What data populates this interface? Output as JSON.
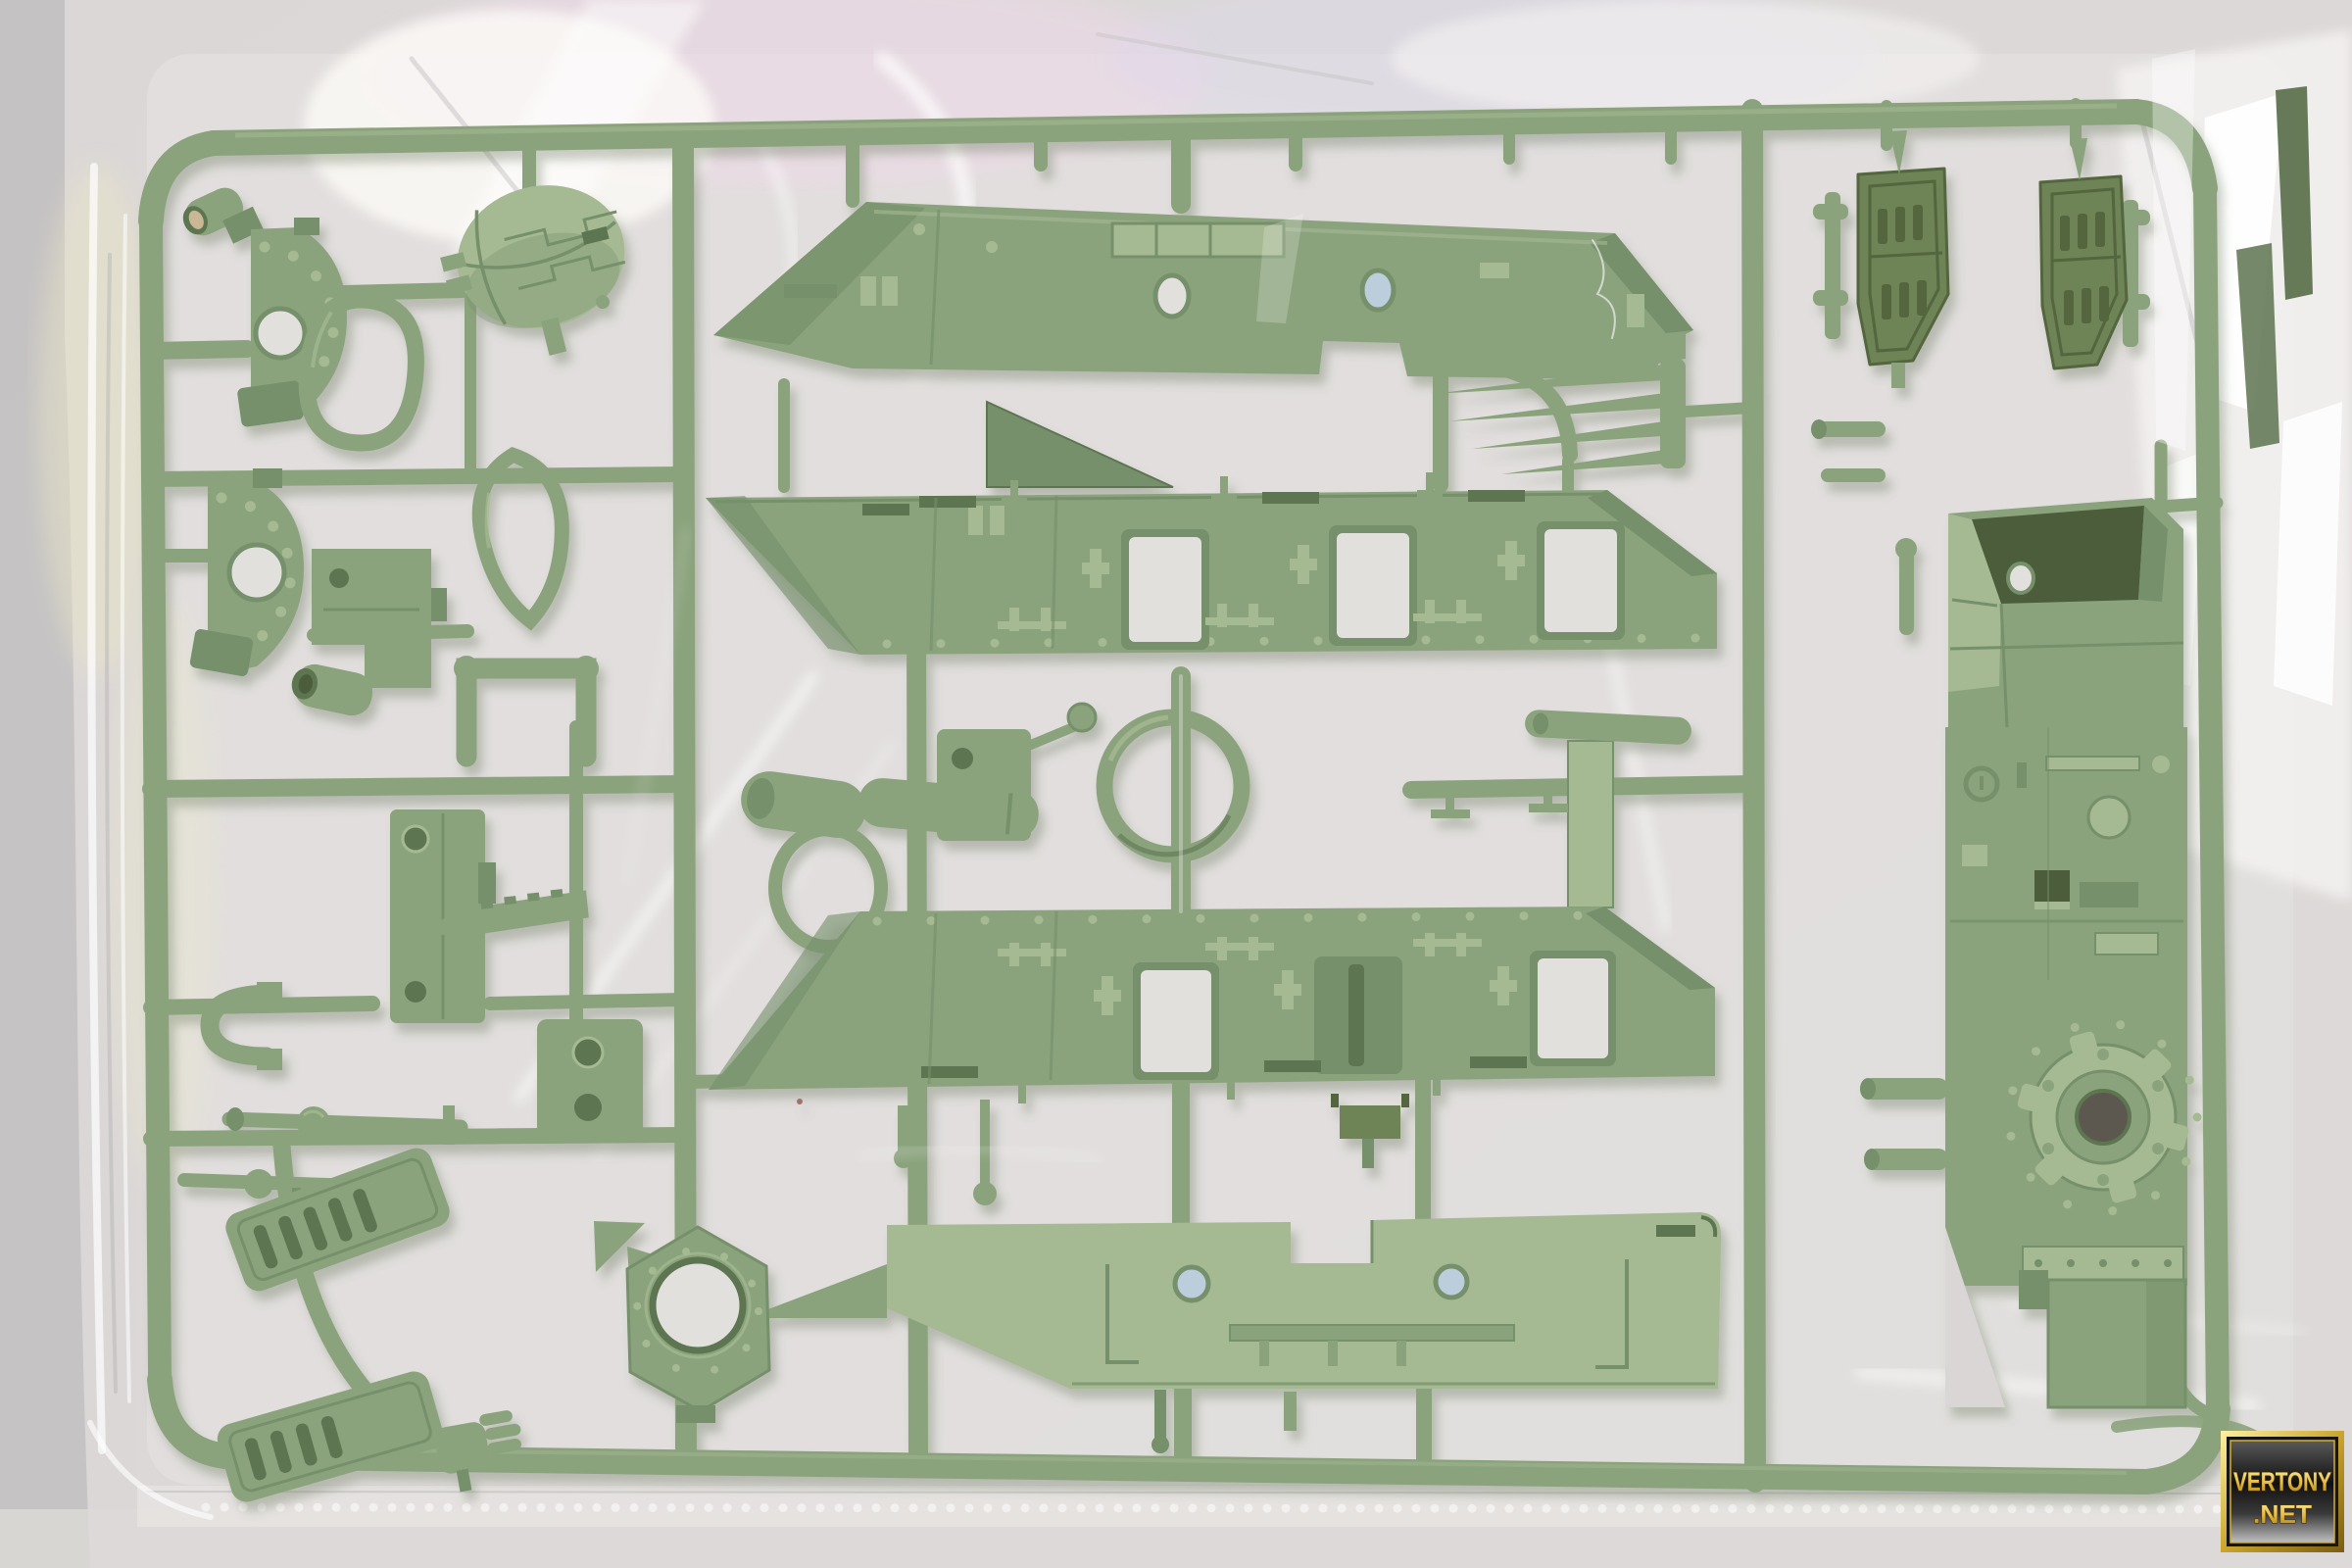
{
  "scene": {
    "description": "Photograph of an olive-green injection-molded model kit sprue (parts runner) sealed inside a clear glossy plastic bag, lying on a light gray surface",
    "contents": "tank/mecha hull panels, side skirts with slots, riveted dome mantlets, ball dome, vented hatches, gear hub hull side, rings, pedals and small fittings"
  },
  "watermark": {
    "line1": "VERTONY",
    "line2": ".NET"
  },
  "colors": {
    "bg1": "#c4c2c3",
    "bg2": "#d8d6d3",
    "bag": "#dcd9d8",
    "bag-lt": "#e6e3e2",
    "seam-dot": "#f4f2f0",
    "g1": "#a5b992",
    "g2": "#8ba37d",
    "g3": "#75906a",
    "g4": "#5d7551",
    "g5": "#4b5d3b",
    "olive": "#6e8356",
    "olive-dk": "#53663e",
    "hole": "#e2e0dd",
    "hole-blue": "#bccddb",
    "bore": "#c9b795",
    "dark-part": "#5e7350",
    "wm-ink": "#4a3505"
  }
}
